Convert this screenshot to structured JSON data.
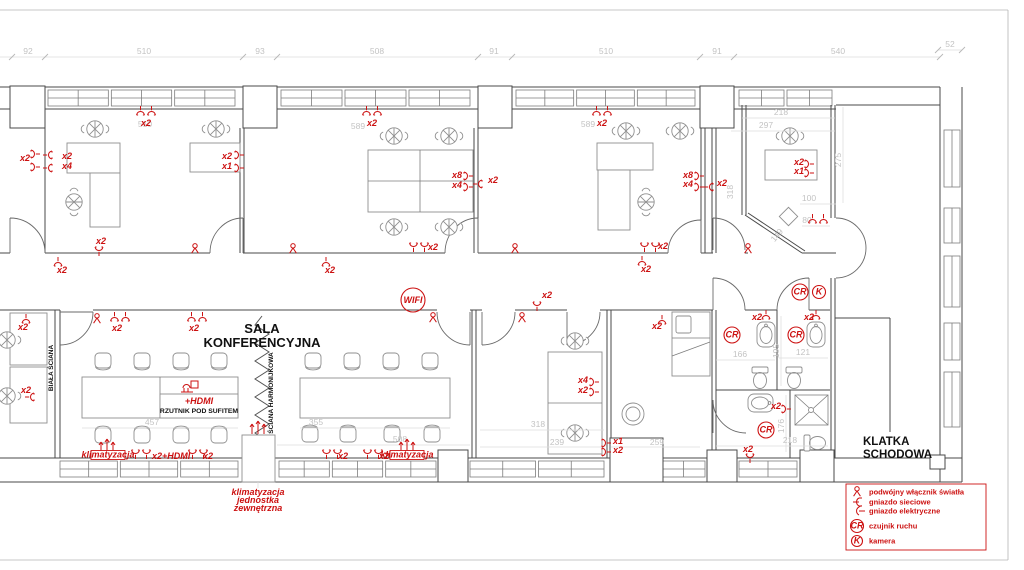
{
  "labels": {
    "sala_line1": "SALA",
    "sala_line2": "KONFERENCYJNA",
    "klatka_line1": "KLATKA",
    "klatka_line2": "SCHODOWA",
    "biala_sciana": "BIAŁA ŚCIANA",
    "sciana_harmonijkowa": "ŚCIANA HARMONIJKOWA",
    "rzutnik": "RZUTNIK POD SUFITEM",
    "hdmi_projector": "+HDMI"
  },
  "colors": {
    "annotation_red": "#cc1111",
    "dimension_gray": "#c3c3c3",
    "wall_gray": "#4a4a4a"
  },
  "legend": {
    "rows": [
      494,
      504,
      513,
      528,
      543
    ],
    "items": [
      {
        "icon": "sw",
        "symbol": "",
        "label": "podwójny włącznik światła"
      },
      {
        "icon": "sockn",
        "symbol": "",
        "label": "gniazdo sieciowe"
      },
      {
        "icon": "socke",
        "symbol": "",
        "label": "gniazdo elektryczne"
      },
      {
        "icon": "cr-circle",
        "symbol": "CR",
        "label": "czujnik ruchu"
      },
      {
        "icon": "k-circle",
        "symbol": "K",
        "label": "kamera"
      }
    ]
  },
  "plan": {
    "dims": {
      "labels": [
        {
          "x": 28,
          "y": 54,
          "t": "92"
        },
        {
          "x": 144,
          "y": 54,
          "t": "510"
        },
        {
          "x": 260,
          "y": 54,
          "t": "93"
        },
        {
          "x": 377,
          "y": 54,
          "t": "508"
        },
        {
          "x": 494,
          "y": 54,
          "t": "91"
        },
        {
          "x": 606,
          "y": 54,
          "t": "510"
        },
        {
          "x": 717,
          "y": 54,
          "t": "91"
        },
        {
          "x": 838,
          "y": 54,
          "t": "540"
        },
        {
          "x": 950,
          "y": 47,
          "t": "52"
        },
        {
          "x": 145,
          "y": 127,
          "t": "510"
        },
        {
          "x": 358,
          "y": 129,
          "t": "589"
        },
        {
          "x": 588,
          "y": 127,
          "t": "589"
        },
        {
          "x": 781,
          "y": 115,
          "t": "218"
        },
        {
          "x": 766,
          "y": 128,
          "t": "297"
        },
        {
          "x": 841,
          "y": 160,
          "t": "275",
          "r": -90
        },
        {
          "x": 809,
          "y": 201,
          "t": "100"
        },
        {
          "x": 807,
          "y": 223,
          "t": "80"
        },
        {
          "x": 779,
          "y": 237,
          "t": "149",
          "r": -50
        },
        {
          "x": 733,
          "y": 192,
          "t": "318",
          "r": -90
        },
        {
          "x": 152,
          "y": 425,
          "t": "457"
        },
        {
          "x": 316,
          "y": 425,
          "t": "355"
        },
        {
          "x": 400,
          "y": 442,
          "t": "508"
        },
        {
          "x": 538,
          "y": 427,
          "t": "318"
        },
        {
          "x": 557,
          "y": 445,
          "t": "239"
        },
        {
          "x": 657,
          "y": 445,
          "t": "259"
        },
        {
          "x": 740,
          "y": 357,
          "t": "166"
        },
        {
          "x": 779,
          "y": 351,
          "t": "195",
          "r": -90
        },
        {
          "x": 803,
          "y": 355,
          "t": "121"
        },
        {
          "x": 784,
          "y": 426,
          "t": "176",
          "r": -90
        },
        {
          "x": 790,
          "y": 443,
          "t": "218"
        }
      ],
      "lines": [
        [
          0,
          57,
          940,
          57
        ],
        [
          938,
          50,
          962,
          50
        ],
        [
          742,
          118,
          835,
          118
        ],
        [
          731,
          131,
          835,
          131
        ],
        [
          843,
          107,
          843,
          203
        ],
        [
          800,
          204,
          836,
          204
        ],
        [
          802,
          226,
          830,
          226
        ],
        [
          82,
          428,
          238,
          428
        ],
        [
          300,
          428,
          450,
          428
        ],
        [
          277,
          445,
          470,
          445
        ],
        [
          480,
          430,
          604,
          430
        ],
        [
          480,
          447,
          604,
          447
        ],
        [
          611,
          447,
          700,
          447
        ],
        [
          716,
          360,
          775,
          360
        ],
        [
          779,
          358,
          828,
          358
        ],
        [
          716,
          446,
          828,
          446
        ],
        [
          781,
          316,
          781,
          386
        ],
        [
          786,
          395,
          786,
          452
        ],
        [
          258,
          482,
          258,
          488
        ]
      ],
      "ticks": [
        [
          12,
          57
        ],
        [
          45,
          57
        ],
        [
          243,
          57
        ],
        [
          277,
          57
        ],
        [
          478,
          57
        ],
        [
          512,
          57
        ],
        [
          700,
          57
        ],
        [
          734,
          57
        ],
        [
          940,
          57
        ],
        [
          938,
          50
        ],
        [
          962,
          50
        ]
      ]
    },
    "red": {
      "texts": [
        {
          "x": 141,
          "y": 126,
          "t": "x2"
        },
        {
          "x": 367,
          "y": 126,
          "t": "x2"
        },
        {
          "x": 597,
          "y": 126,
          "t": "x2"
        },
        {
          "x": 20,
          "y": 161,
          "t": "x2"
        },
        {
          "x": 62,
          "y": 159,
          "t": "x2"
        },
        {
          "x": 62,
          "y": 169,
          "t": "x4"
        },
        {
          "x": 222,
          "y": 159,
          "t": "x2"
        },
        {
          "x": 222,
          "y": 169,
          "t": "x1"
        },
        {
          "x": 96,
          "y": 244,
          "t": "x2"
        },
        {
          "x": 57,
          "y": 273,
          "t": "x2"
        },
        {
          "x": 325,
          "y": 273,
          "t": "x2"
        },
        {
          "x": 641,
          "y": 272,
          "t": "x2"
        },
        {
          "x": 452,
          "y": 178,
          "t": "x8"
        },
        {
          "x": 452,
          "y": 188,
          "t": "x4"
        },
        {
          "x": 488,
          "y": 183,
          "t": "x2"
        },
        {
          "x": 428,
          "y": 250,
          "t": "x2"
        },
        {
          "x": 683,
          "y": 178,
          "t": "x8"
        },
        {
          "x": 683,
          "y": 187,
          "t": "x4"
        },
        {
          "x": 717,
          "y": 186,
          "t": "x2"
        },
        {
          "x": 658,
          "y": 249,
          "t": "x2"
        },
        {
          "x": 542,
          "y": 298,
          "t": "x2"
        },
        {
          "x": 112,
          "y": 331,
          "t": "x2"
        },
        {
          "x": 189,
          "y": 331,
          "t": "x2"
        },
        {
          "x": 794,
          "y": 165,
          "t": "x2"
        },
        {
          "x": 794,
          "y": 174,
          "t": "x1"
        },
        {
          "x": 18,
          "y": 330,
          "t": "x2"
        },
        {
          "x": 21,
          "y": 393,
          "t": "x2"
        },
        {
          "x": 578,
          "y": 383,
          "t": "x4"
        },
        {
          "x": 578,
          "y": 393,
          "t": "x2"
        },
        {
          "x": 613,
          "y": 444,
          "t": "x1"
        },
        {
          "x": 613,
          "y": 453,
          "t": "x2"
        },
        {
          "x": 652,
          "y": 329,
          "t": "x2"
        },
        {
          "x": 752,
          "y": 320,
          "t": "x2"
        },
        {
          "x": 804,
          "y": 320,
          "t": "x2"
        },
        {
          "x": 771,
          "y": 409,
          "t": "x2"
        },
        {
          "x": 743,
          "y": 452,
          "t": "x2"
        },
        {
          "x": 152,
          "y": 459,
          "t": "x2+HDMI"
        },
        {
          "x": 203,
          "y": 459,
          "t": "x2"
        },
        {
          "x": 338,
          "y": 459,
          "t": "x2"
        },
        {
          "x": 379,
          "y": 459,
          "t": "x2"
        },
        {
          "x": 199,
          "y": 404,
          "t": "+HDMI",
          "m": 1,
          "fs": 7
        },
        {
          "x": 258,
          "y": 495,
          "t": "klimatyzacja",
          "m": 1,
          "fs": 6.5
        },
        {
          "x": 258,
          "y": 503,
          "t": "jednostka",
          "m": 1,
          "fs": 6.5
        },
        {
          "x": 258,
          "y": 511,
          "t": "zewnętrzna",
          "m": 1,
          "fs": 6.5
        }
      ],
      "symbols": [
        {
          "k": "sock2",
          "x": 146,
          "y": 112
        },
        {
          "k": "sock2",
          "x": 372,
          "y": 112
        },
        {
          "k": "sock2",
          "x": 602,
          "y": 112
        },
        {
          "k": "sock2",
          "x": 120,
          "y": 318
        },
        {
          "k": "sock2",
          "x": 197,
          "y": 318
        },
        {
          "k": "sock2",
          "x": 419,
          "y": 246,
          "r": 180
        },
        {
          "k": "sock2",
          "x": 650,
          "y": 246,
          "r": 180
        },
        {
          "k": "sock2",
          "x": 141,
          "y": 453,
          "r": 180
        },
        {
          "k": "sock2",
          "x": 198,
          "y": 453,
          "r": 180
        },
        {
          "k": "sock2",
          "x": 332,
          "y": 453,
          "r": 180
        },
        {
          "k": "sock2",
          "x": 373,
          "y": 453,
          "r": 180
        },
        {
          "k": "sock2",
          "x": 818,
          "y": 220
        },
        {
          "k": "sock",
          "x": 34,
          "y": 154,
          "r": 90
        },
        {
          "k": "sock",
          "x": 34,
          "y": 167,
          "r": 90
        },
        {
          "k": "sock",
          "x": 49,
          "y": 155,
          "r": -90
        },
        {
          "k": "sock",
          "x": 49,
          "y": 168,
          "r": -90
        },
        {
          "k": "sock",
          "x": 238,
          "y": 155,
          "r": 90
        },
        {
          "k": "sock",
          "x": 238,
          "y": 168,
          "r": 90
        },
        {
          "k": "sock",
          "x": 99,
          "y": 250,
          "r": 180
        },
        {
          "k": "sock",
          "x": 58,
          "y": 263
        },
        {
          "k": "sock",
          "x": 326,
          "y": 263
        },
        {
          "k": "sock",
          "x": 642,
          "y": 262
        },
        {
          "k": "sock",
          "x": 467,
          "y": 176,
          "r": 90
        },
        {
          "k": "sock",
          "x": 467,
          "y": 187,
          "r": 90
        },
        {
          "k": "sock",
          "x": 479,
          "y": 184,
          "r": -90
        },
        {
          "k": "sock",
          "x": 698,
          "y": 176,
          "r": 90
        },
        {
          "k": "sock",
          "x": 698,
          "y": 187,
          "r": 90
        },
        {
          "k": "sock",
          "x": 710,
          "y": 187,
          "r": -90
        },
        {
          "k": "sock",
          "x": 537,
          "y": 305,
          "r": 180
        },
        {
          "k": "sock",
          "x": 808,
          "y": 164,
          "r": 90
        },
        {
          "k": "sock",
          "x": 808,
          "y": 173,
          "r": 90
        },
        {
          "k": "sock",
          "x": 26,
          "y": 320
        },
        {
          "k": "sock",
          "x": 31,
          "y": 397,
          "r": -90
        },
        {
          "k": "sock",
          "x": 593,
          "y": 382,
          "r": 90
        },
        {
          "k": "sock",
          "x": 593,
          "y": 392,
          "r": 90
        },
        {
          "k": "sock",
          "x": 605,
          "y": 443,
          "r": 90
        },
        {
          "k": "sock",
          "x": 605,
          "y": 452,
          "r": 90
        },
        {
          "k": "sock",
          "x": 662,
          "y": 321
        },
        {
          "k": "sock",
          "x": 766,
          "y": 316
        },
        {
          "k": "sock",
          "x": 816,
          "y": 316
        },
        {
          "k": "sock",
          "x": 785,
          "y": 409,
          "r": 90
        },
        {
          "k": "sock",
          "x": 750,
          "y": 457,
          "r": 180
        },
        {
          "k": "sw",
          "x": 195,
          "y": 249
        },
        {
          "k": "sw",
          "x": 293,
          "y": 249
        },
        {
          "k": "sw",
          "x": 515,
          "y": 249
        },
        {
          "k": "sw",
          "x": 748,
          "y": 249
        },
        {
          "k": "sw",
          "x": 97,
          "y": 319
        },
        {
          "k": "sw",
          "x": 433,
          "y": 318
        },
        {
          "k": "sw",
          "x": 522,
          "y": 318
        },
        {
          "k": "fan",
          "x": 107,
          "y": 446
        },
        {
          "k": "fan",
          "x": 407,
          "y": 446
        },
        {
          "k": "fan",
          "x": 258,
          "y": 428
        },
        {
          "k": "proj",
          "x": 190,
          "y": 388
        }
      ],
      "circles": [
        {
          "x": 413,
          "y": 300,
          "r": 12,
          "t": "WIFI",
          "fs": 8.5
        },
        {
          "x": 732,
          "y": 335,
          "r": 8,
          "t": "CR",
          "fs": 7.5
        },
        {
          "x": 796,
          "y": 335,
          "r": 8,
          "t": "CR",
          "fs": 7.5
        },
        {
          "x": 800,
          "y": 292,
          "r": 8,
          "t": "CR",
          "fs": 7.5
        },
        {
          "x": 819,
          "y": 292,
          "r": 6.5,
          "t": "K",
          "fs": 7.5
        },
        {
          "x": 766,
          "y": 430,
          "r": 8,
          "t": "CR",
          "fs": 7.5
        }
      ],
      "boxes": [
        {
          "x": 108,
          "y": 457,
          "w": 34,
          "t": "klimatyzacja"
        },
        {
          "x": 407,
          "y": 457,
          "w": 34,
          "t": "klimatyzacja"
        }
      ]
    }
  }
}
